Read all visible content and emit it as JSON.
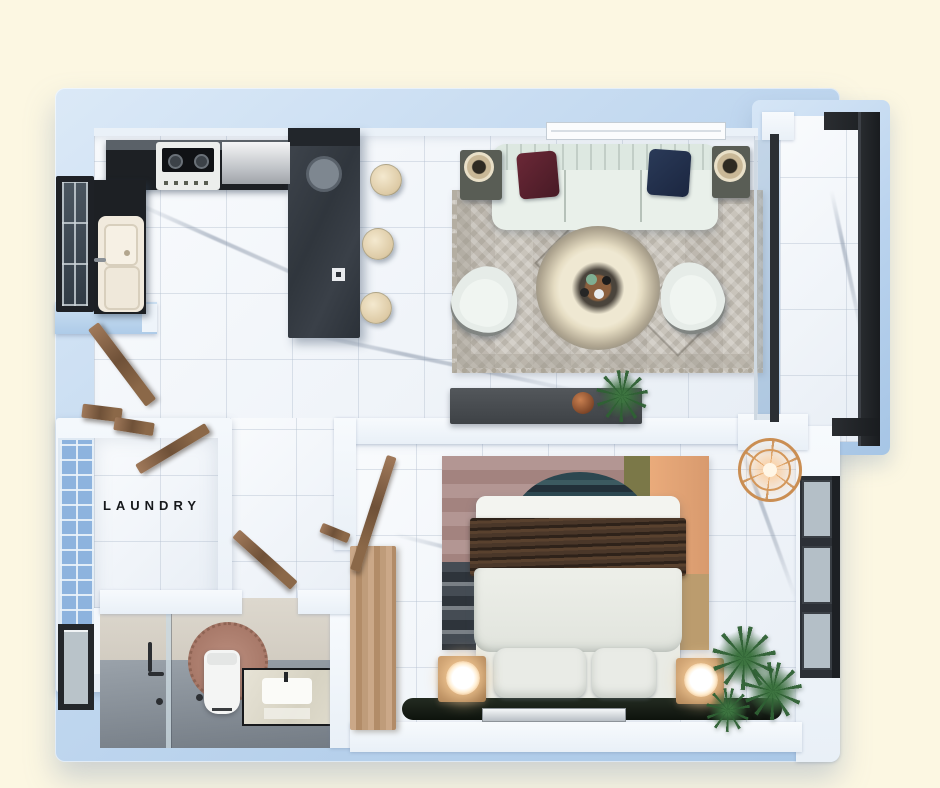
{
  "scene": {
    "kind": "3d-floor-plan-top-view",
    "background_color": "#fcf7e2"
  },
  "labels": {
    "laundry": "LAUNDRY"
  },
  "rooms": [
    {
      "id": "kitchen"
    },
    {
      "id": "living-room"
    },
    {
      "id": "balcony"
    },
    {
      "id": "laundry"
    },
    {
      "id": "hallway"
    },
    {
      "id": "bathroom"
    },
    {
      "id": "bedroom"
    }
  ],
  "palette": {
    "background_cream": "#fcf7e2",
    "wall_exterior_blue": "#bdd5ee",
    "wall_interior_white": "#f2f6fa",
    "floor_marble": "#f3f6fa",
    "floor_bathroom_gray": "#868e96",
    "counter_dark": "#1d2024",
    "island_charcoal": "#343a41",
    "wood_door": "#8a6b4e",
    "wood_nightstand": "#b98a5c",
    "sofa_mint_white": "#e9f0ea",
    "pillow_maroon": "#5a2230",
    "pillow_navy": "#233049",
    "blanket_brown": "#4a3729",
    "headboard_dark": "#1c211d",
    "rug_living_gray": "#c9c4bb",
    "rug_bed_mauve": "#ab8e89",
    "rug_bed_teal": "#2e4a52",
    "rug_bed_olive": "#7b7848",
    "rug_bed_peach": "#e5a274",
    "rug_bed_tan": "#bb9c6e",
    "plant_green": "#2f6134",
    "glass_block_blue": "#8db3de",
    "lamp_glow": "#ffeed2",
    "ceiling_light_brass": "#c98d52",
    "bath_rug_rose": "#b28577"
  },
  "furniture": {
    "kitchen": [
      "l-shaped-counter",
      "gas-stove",
      "stainless-worktop",
      "double-sink",
      "island-counter",
      "bar-stools-x3",
      "framed-window"
    ],
    "living_room": [
      "tufted-sofa",
      "maroon-pillow",
      "navy-pillow",
      "side-table-lamp-left",
      "side-table-lamp-right",
      "patterned-area-rug",
      "round-coffee-table",
      "armchair-left",
      "armchair-right",
      "tv-console",
      "copper-vase",
      "potted-plant",
      "window-above-sofa"
    ],
    "balcony": [
      "glass-railing",
      "sliding-glass-door",
      "marble-deck"
    ],
    "laundry": [
      "glass-block-window"
    ],
    "hallway": [
      "open-wood-doors"
    ],
    "bathroom": [
      "glass-shower-panel",
      "shower-fixtures",
      "toilet",
      "round-rose-rug",
      "vanity-with-sink",
      "framed-window",
      "floor-drain"
    ],
    "bedroom": [
      "double-bed",
      "brown-pleated-blanket",
      "white-duvet",
      "two-pillows",
      "dark-headboard",
      "silver-tray",
      "nightstand-left",
      "nightstand-right",
      "glowing-sphere-lamp-left",
      "glowing-sphere-lamp-right",
      "striped-area-rug",
      "wood-wardrobe",
      "potted-plants-x3",
      "ceiling-fan-light",
      "triple-pane-window"
    ]
  }
}
